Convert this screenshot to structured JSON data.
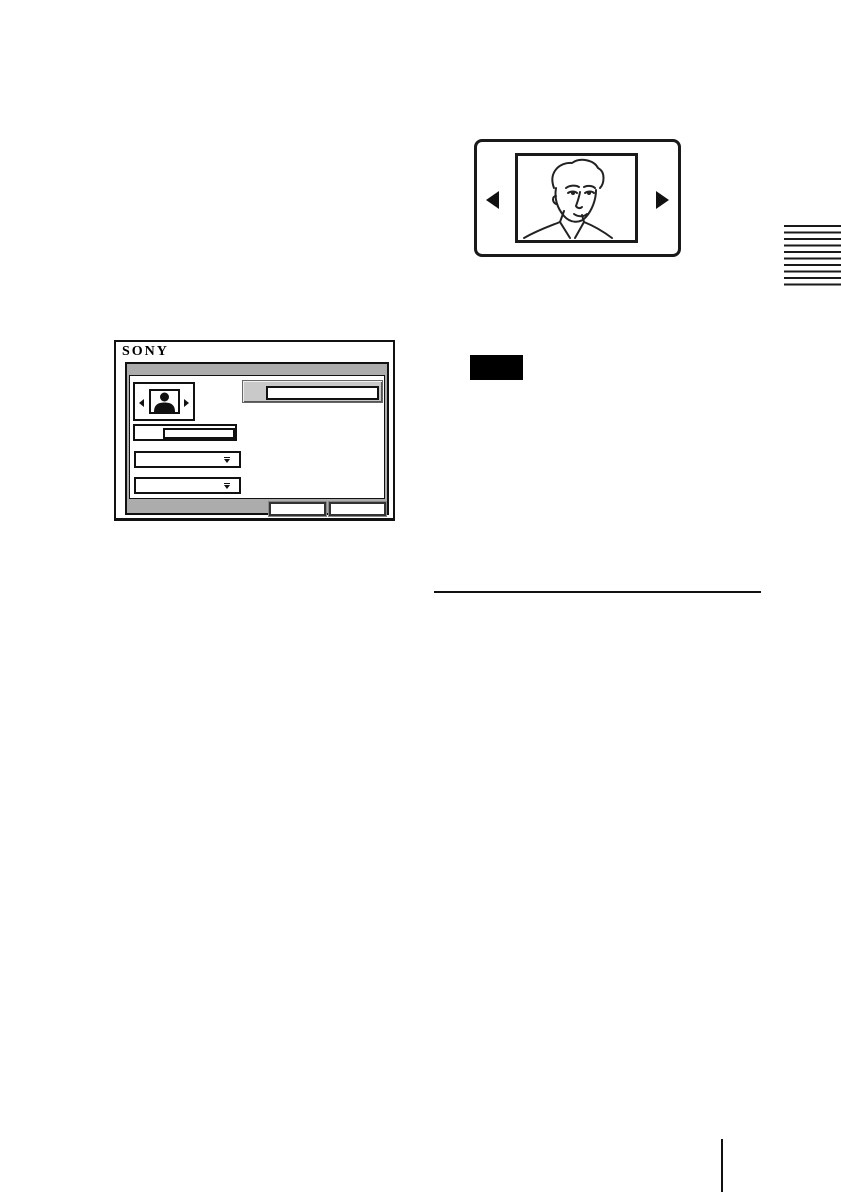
{
  "carousel": {
    "prev_icon": "left-arrow",
    "next_icon": "right-arrow",
    "image": "man-portrait-line-drawing"
  },
  "sony_dialog": {
    "logo_text": "SONY",
    "photo_selector": {
      "prev_icon": "small-left-arrow",
      "next_icon": "small-right-arrow",
      "thumbnail_icon": "person-silhouette"
    },
    "highlighted_field_value": "",
    "text_field_value": "",
    "dropdown1_value": "",
    "dropdown2_value": "",
    "button1_label": "",
    "button2_label": ""
  },
  "note_badge_label": "",
  "side_tab": {
    "stripe_count": 10
  },
  "colors": {
    "line_black": "#1a1a1a",
    "panel_gray": "#acacac",
    "highlight_field_gray": "#c9c9c9",
    "page_background": "#ffffff"
  }
}
